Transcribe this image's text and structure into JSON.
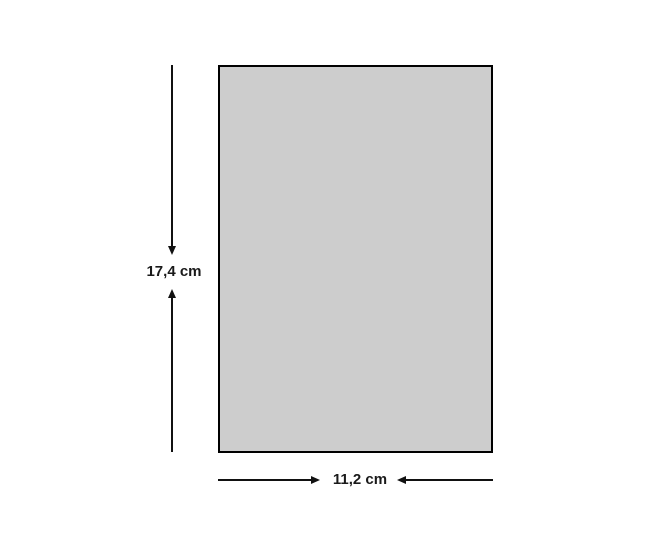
{
  "diagram": {
    "title": "rectangle-dimension-figure",
    "shape": {
      "type": "rectangle",
      "fill_color": "#cdcdcd",
      "border_color": "#000000"
    },
    "height_dimension": {
      "label": "17,4 cm",
      "value": "17,4",
      "unit": "cm",
      "orientation": "vertical",
      "arrow_style": "inward"
    },
    "width_dimension": {
      "label": "11,2 cm",
      "value": "11,2",
      "unit": "cm",
      "orientation": "horizontal",
      "arrow_style": "inward"
    },
    "colors": {
      "background": "#ffffff",
      "line": "#111111",
      "text": "#1a1a1a"
    }
  }
}
